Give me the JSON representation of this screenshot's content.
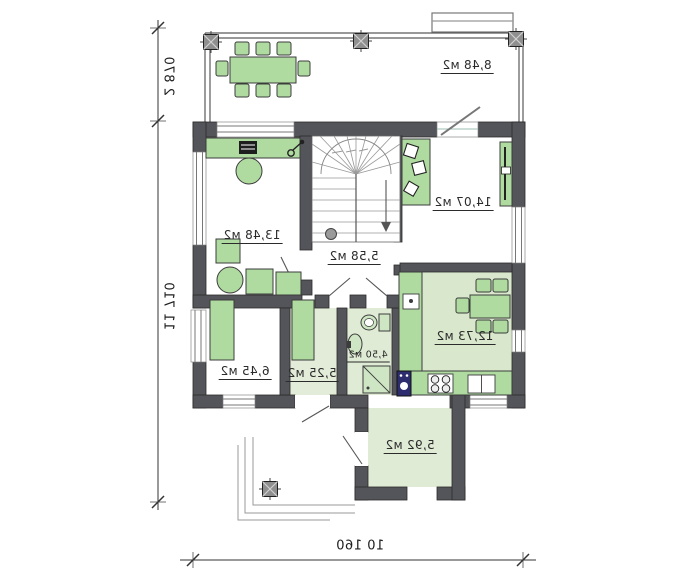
{
  "plan": {
    "rooms": {
      "terrace": "8,48 м2",
      "study": "13,48 м2",
      "bedroom": "14,07 м2",
      "hall": "5,58 м2",
      "kitchen": "12,73 м2",
      "bathroom": "4,50 м2",
      "room_645": "6,45 м2",
      "room_525": "5,25 м2",
      "entry": "5,92 м2"
    },
    "dimensions": {
      "terrace_depth": "2 870",
      "total_height": "11 710",
      "total_width": "10 160"
    },
    "colors": {
      "wall": "#54555a",
      "furniture_green": "#afdba0",
      "floor_tint": "#dfead4",
      "appliance_navy": "#2c2c6e"
    }
  }
}
